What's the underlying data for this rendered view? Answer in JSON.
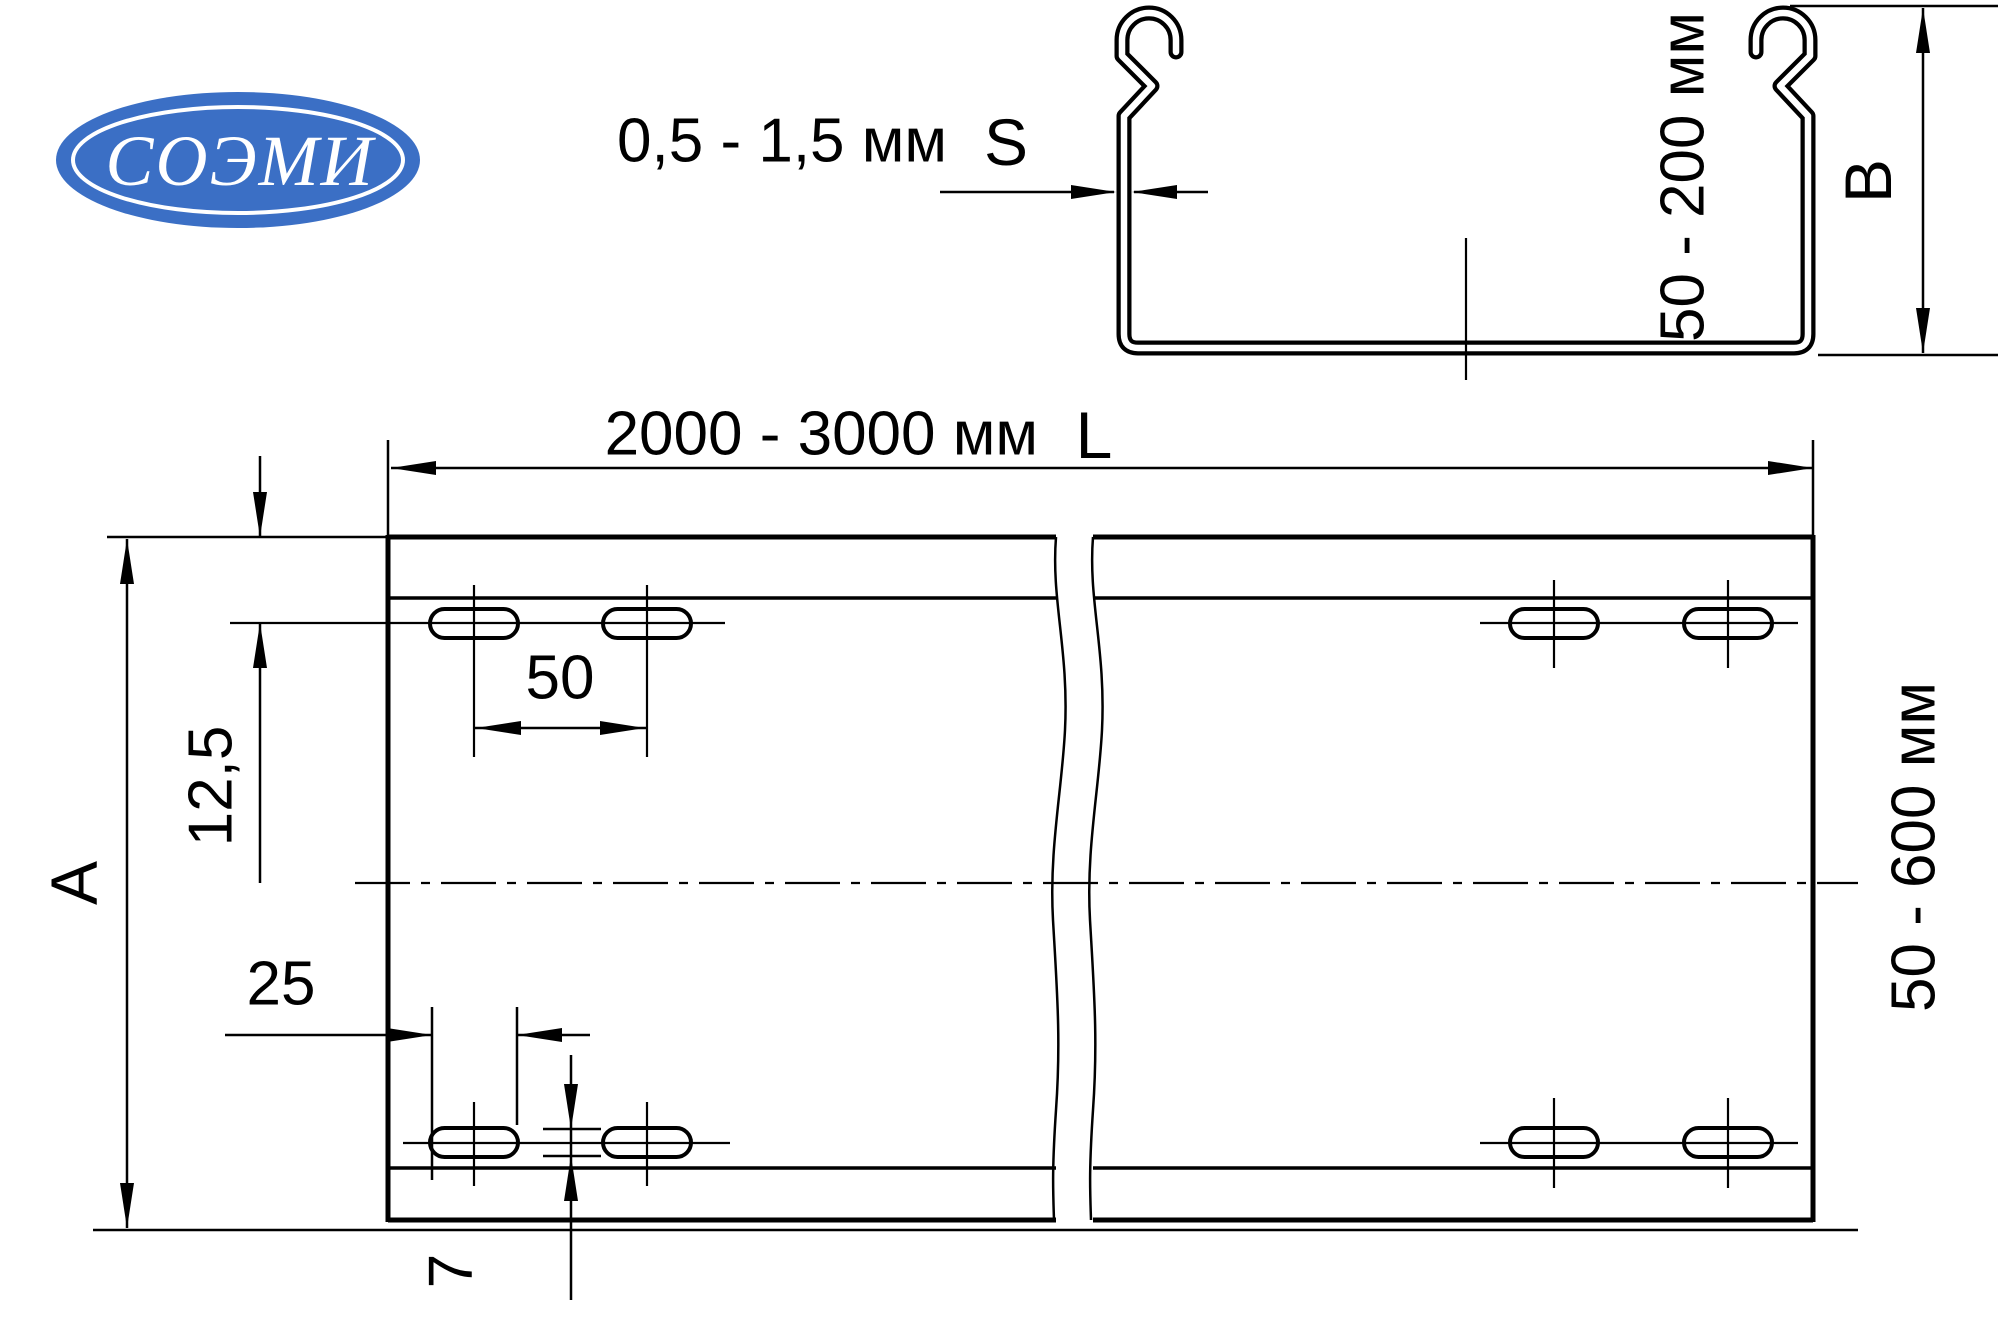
{
  "page": {
    "background": "#ffffff",
    "line_color": "#000000"
  },
  "logo": {
    "text": "СОЭМИ",
    "fill": "#3b6fc5",
    "text_color": "#ffffff"
  },
  "section_view": {
    "thickness_value": "0,5 - 1,5 мм",
    "thickness_symbol": "S",
    "height_value": "50 - 200 мм",
    "height_symbol": "B"
  },
  "plan_view": {
    "length_value": "2000 - 3000 мм",
    "length_symbol": "L",
    "width_value": "50 - 600 мм",
    "width_symbol": "A",
    "edge_offset_value": "12,5",
    "hole_spacing_value": "50",
    "hole_length_value": "25",
    "hole_width_value": "7"
  }
}
